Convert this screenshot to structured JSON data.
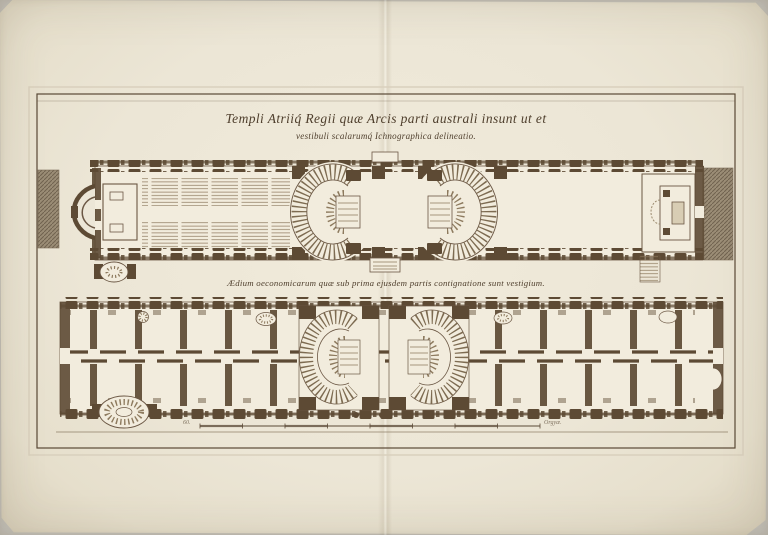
{
  "plate": {
    "title_line1": "Templi Atriiq́ Regii quæ Arcis parti australi insunt ut et",
    "title_line2": "vestibuli scalarumq́ Ichnographica delineatio.",
    "caption_lower_plan": "Ædium oeconomicarum quæ sub prima ejusdem partis contignatione sunt vestigium.",
    "scale_bar": {
      "label_left": "60.",
      "label_right": "Orgyæ."
    }
  },
  "colors": {
    "photo_background": "#c6c3bc",
    "paper": "#ece6d6",
    "plan_floor": "#f2ecdd",
    "ink": "#4e3e2c",
    "wall": "#5d4a34",
    "hatch_band": "#9b8d76"
  }
}
